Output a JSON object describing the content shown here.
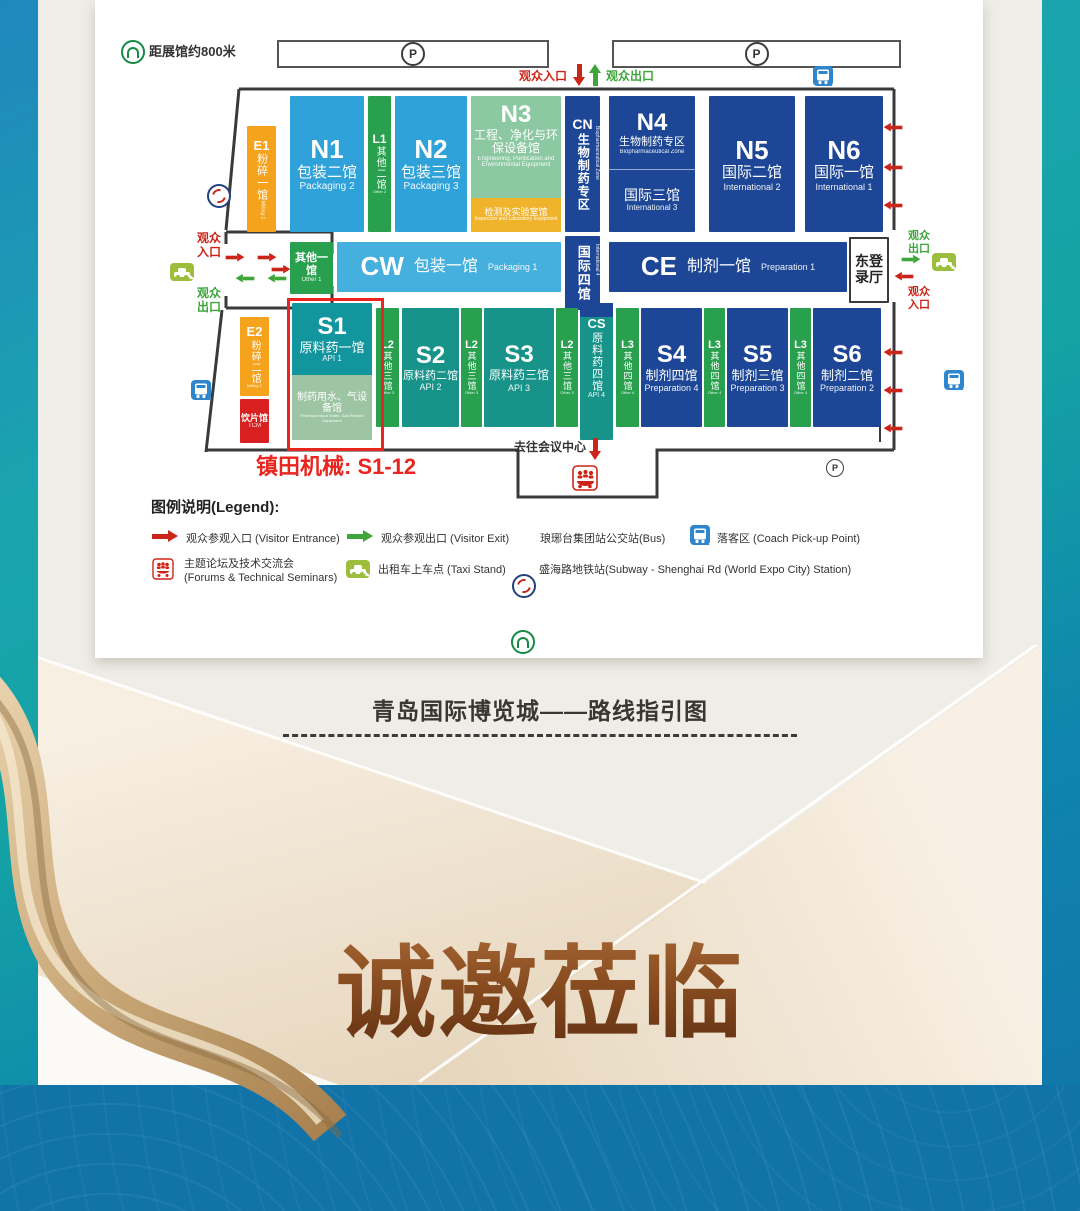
{
  "map": {
    "distance_note": "距展馆约800米",
    "parking_letter": "P",
    "entrance_label": "观众入口",
    "exit_label": "观众出口",
    "east_hall": "东登录厅",
    "to_conference": "去往会议中心",
    "exhibitor_note": "镇田机械: S1-12",
    "halls": {
      "e1": {
        "id": "E1",
        "name": "粉碎一馆",
        "en": "Milling 1"
      },
      "n1": {
        "id": "N1",
        "name": "包装二馆",
        "en": "Packaging 2"
      },
      "l1": {
        "id": "L1",
        "name": "其他二馆",
        "en": "Other 2"
      },
      "n2": {
        "id": "N2",
        "name": "包装三馆",
        "en": "Packaging 3"
      },
      "n3": {
        "id": "N3",
        "name": "工程、净化与环保设备馆",
        "en": "Engineering, Purification and Environmental Equipment"
      },
      "n3_lab": {
        "name": "检测及实验室馆",
        "en": "Inspection and Laboratory Equipment"
      },
      "cn": {
        "id": "CN",
        "name": "生物制药专区",
        "en": "Biopharmaceutical Zone"
      },
      "n4": {
        "id": "N4",
        "zone": "生物制药专区",
        "zone_en": "Biopharmaceutical Zone",
        "name": "国际三馆",
        "en": "International 3"
      },
      "n5": {
        "id": "N5",
        "name": "国际二馆",
        "en": "International 2"
      },
      "n6": {
        "id": "N6",
        "name": "国际一馆",
        "en": "International 1"
      },
      "other1": {
        "name": "其他一馆",
        "en": "Other 1"
      },
      "cw": {
        "id": "CW",
        "name": "包装一馆",
        "en": "Packaging 1"
      },
      "intl4": {
        "name": "国际四馆",
        "en": "International 4"
      },
      "ce": {
        "id": "CE",
        "name": "制剂一馆",
        "en": "Preparation 1"
      },
      "e2": {
        "id": "E2",
        "name": "粉碎二馆",
        "en": "Milling 2"
      },
      "tcm": {
        "name": "饮片馆",
        "en": "TCM"
      },
      "s1": {
        "id": "S1",
        "name": "原料药一馆",
        "en": "API 1"
      },
      "s1_water": {
        "name": "制药用水、气设备馆",
        "en": "Pharmaceutical Water, Gas Related Equipment"
      },
      "l2": {
        "id": "L2",
        "name": "其他三馆",
        "en": "Other 3"
      },
      "s2": {
        "id": "S2",
        "name": "原料药二馆",
        "en": "API 2"
      },
      "s3": {
        "id": "S3",
        "name": "原料药三馆",
        "en": "API 3"
      },
      "cs": {
        "id": "CS",
        "name": "原料药四馆",
        "en": "API 4"
      },
      "l3": {
        "id": "L3",
        "name": "其他四馆",
        "en": "Other 4"
      },
      "s4": {
        "id": "S4",
        "name": "制剂四馆",
        "en": "Preparation 4"
      },
      "s5": {
        "id": "S5",
        "name": "制剂三馆",
        "en": "Preparation 3"
      },
      "s6": {
        "id": "S6",
        "name": "制剂二馆",
        "en": "Preparation 2"
      }
    },
    "legend": {
      "title": "图例说明(Legend):",
      "visitor_entrance": "观众参观入口 (Visitor Entrance)",
      "visitor_exit": "观众参观出口 (Visitor Exit)",
      "bus": "琅琊台集团站公交站(Bus)",
      "coach": "落客区 (Coach Pick-up Point)",
      "forums_l1": "主题论坛及技术交流会",
      "forums_l2": "(Forums & Technical Seminars)",
      "taxi": "出租车上车点 (Taxi Stand)",
      "subway": "盛海路地铁站(Subway - Shenghai Rd (World Expo City) Station)"
    }
  },
  "footer": {
    "title": "青岛国际博览城——路线指引图",
    "invite": "诚邀莅临"
  },
  "colors": {
    "accent_red": "#E8251E",
    "navy": "#1D4796",
    "teal": "#17938A",
    "green": "#28A04E",
    "blue": "#2FA2D9",
    "bottom_band": "#1173A8",
    "gold": "#C9A878"
  }
}
